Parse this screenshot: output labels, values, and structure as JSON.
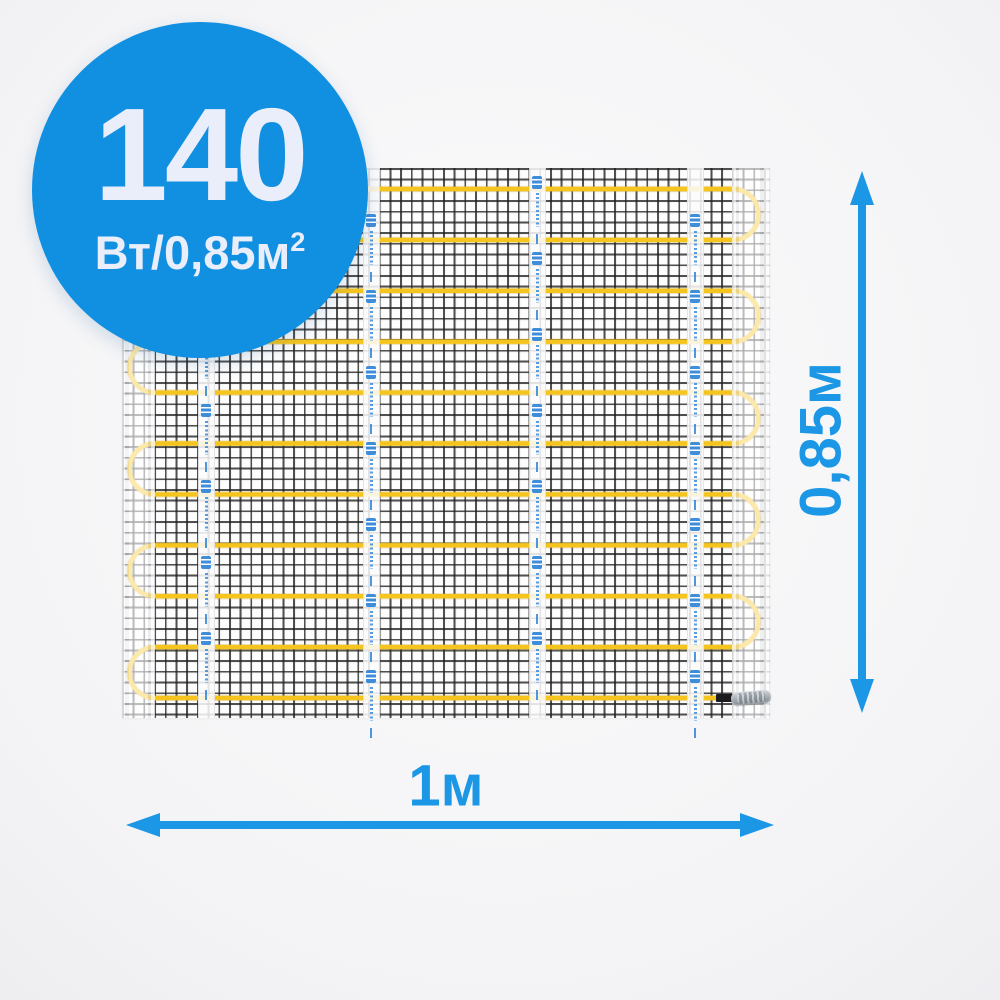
{
  "badge": {
    "value": "140",
    "unit": "Вт/0,85м",
    "unit_sup": "2",
    "bg_color": "#1190e2",
    "text_color": "#e9eefa"
  },
  "dimensions": {
    "height_label": "0,85м",
    "width_label": "1м",
    "arrow_color": "#1b97e6"
  },
  "mat": {
    "cable_color": "#f6c51d",
    "cable_shadow_color": "#caa53a",
    "mesh_line_color": "#1e1e1e",
    "logo_color": "#2f85d8",
    "rows": 11,
    "first_row_y": 21,
    "row_spacing": 50.9,
    "run_left_x": 33,
    "run_right_x": 611,
    "cable_end_x": 600,
    "tape_centers_x": [
      83,
      248,
      414,
      572
    ],
    "tape_mark_unit": 76,
    "tape_mark_offsets": [
      8,
      46,
      8,
      46
    ],
    "tape_marks_per_strip": 7
  }
}
